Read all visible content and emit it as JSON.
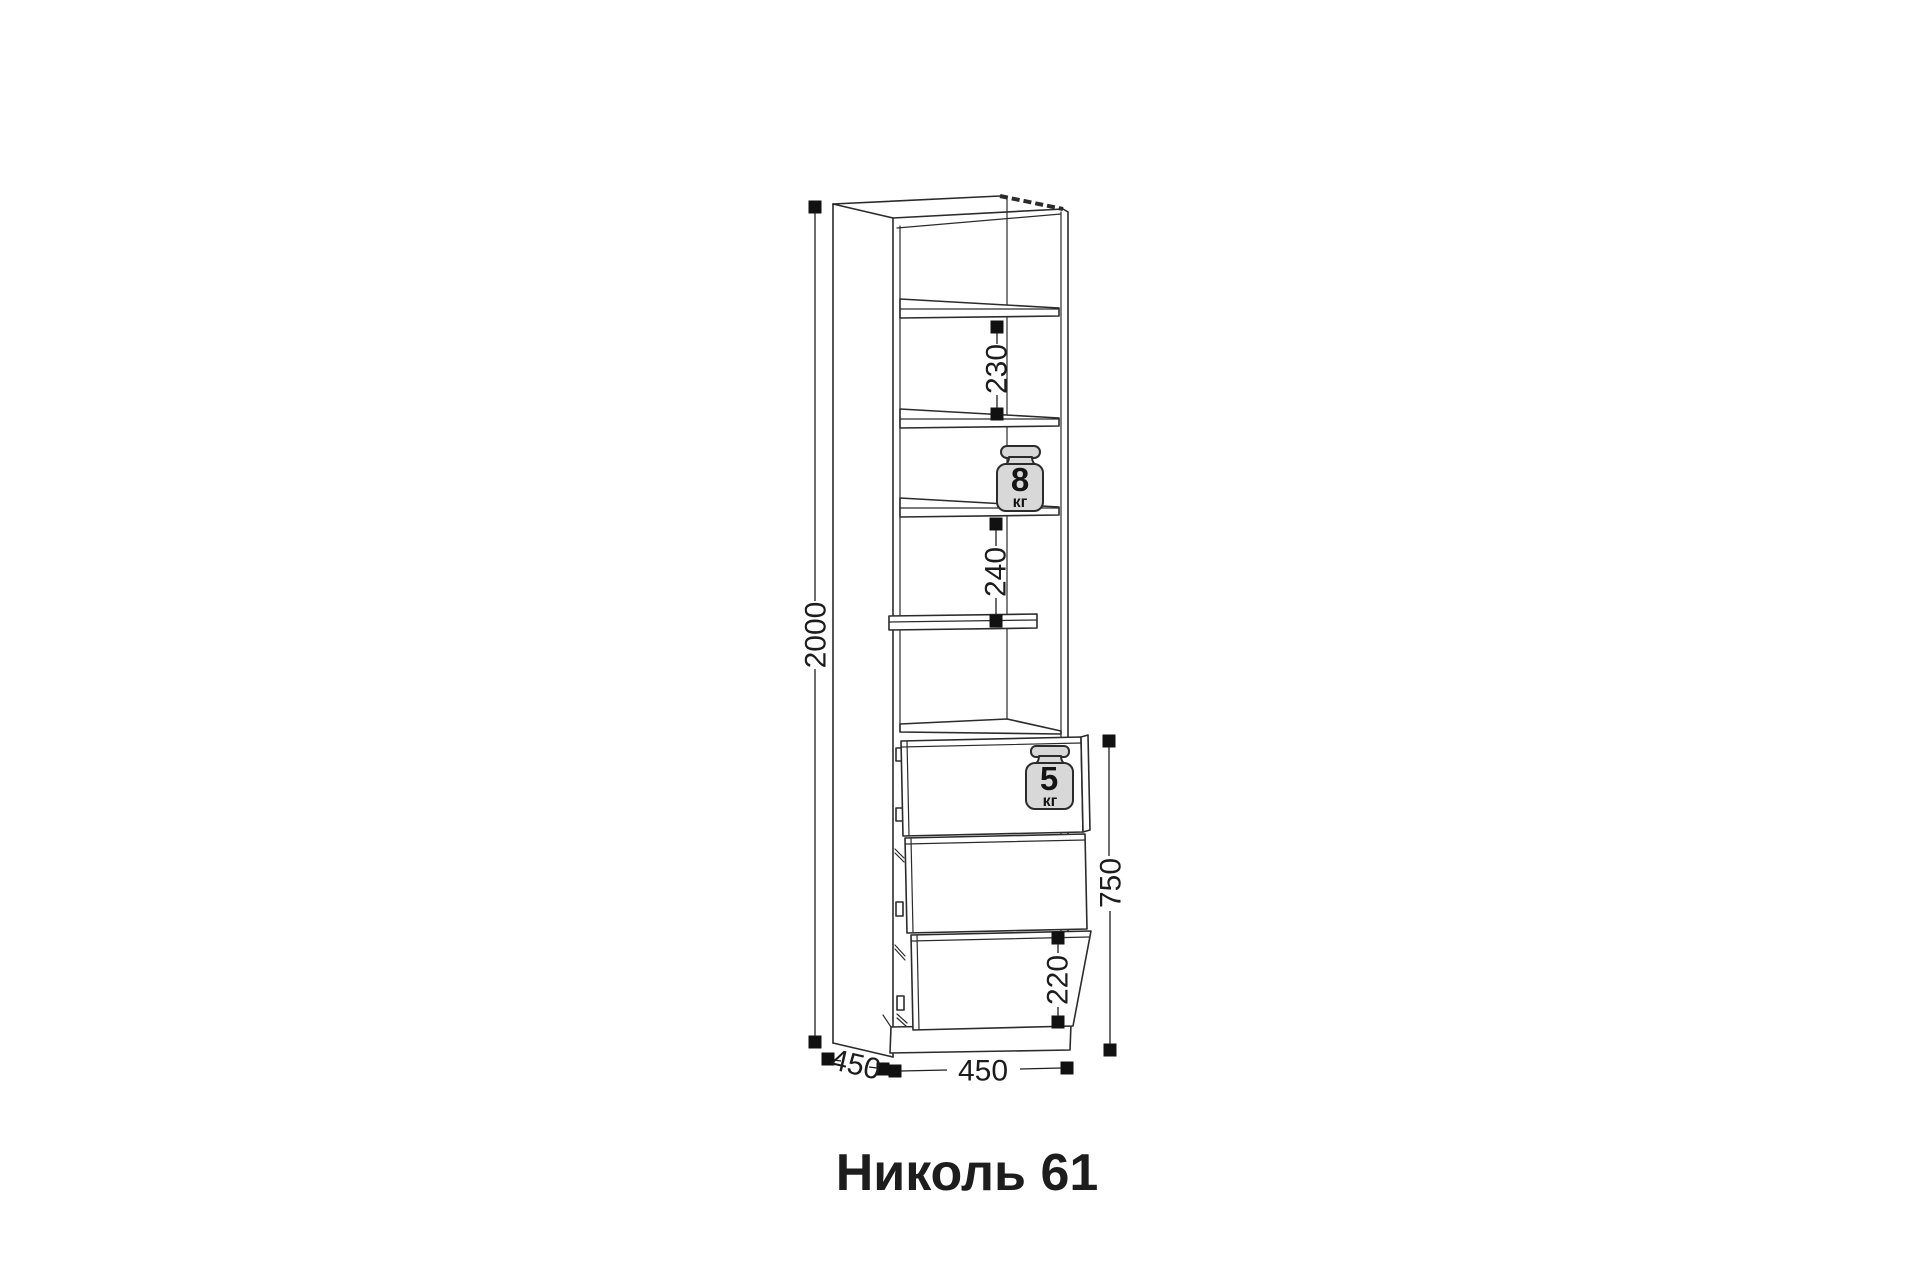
{
  "page": {
    "background": "#ffffff"
  },
  "drawing": {
    "title": "Николь 61",
    "colors": {
      "line": "#2b2b2b",
      "text": "#1c1c1c",
      "marker": "#111111",
      "weight_fill": "#d8d8d8",
      "background": "#ffffff"
    },
    "dimensions": {
      "total_height": "2000",
      "upper_shelf_gap": "230",
      "lower_shelf_gap": "240",
      "drawer_section_height": "750",
      "bottom_drawer_height": "220",
      "width": "450",
      "depth": "450"
    },
    "load_capacity": {
      "shelf": {
        "value": "8",
        "unit": "кг"
      },
      "drawer": {
        "value": "5",
        "unit": "кг"
      }
    }
  }
}
